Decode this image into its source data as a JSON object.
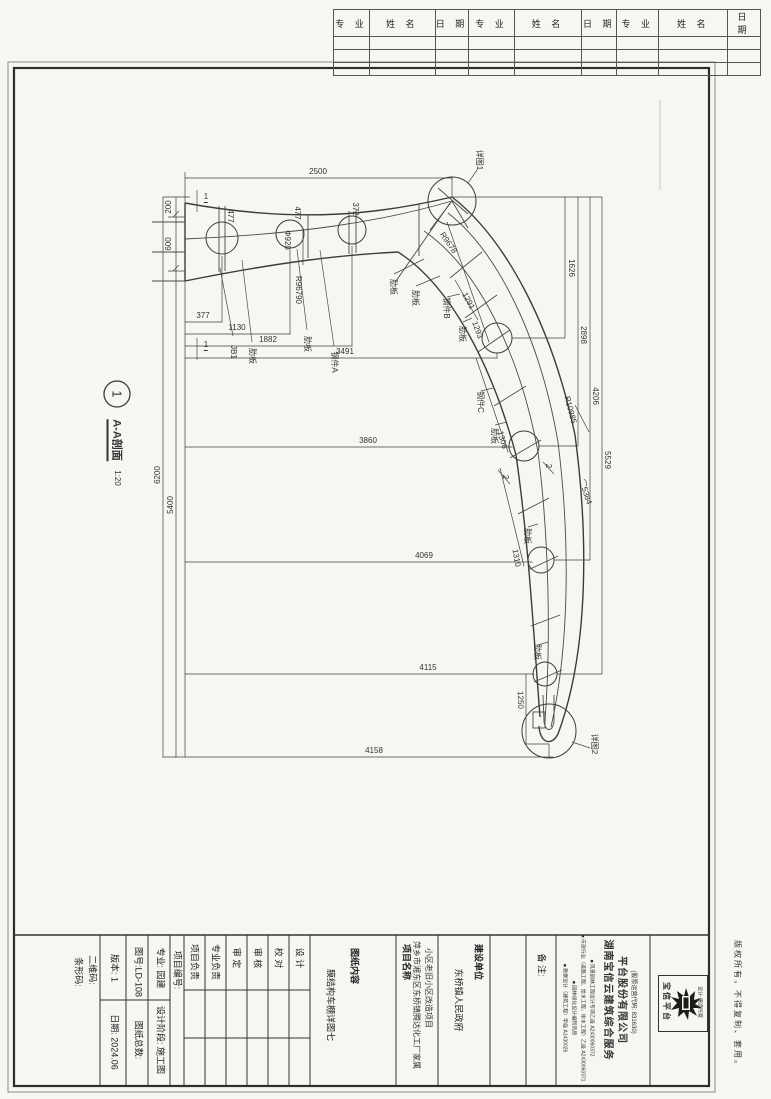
{
  "header_table": {
    "columns": [
      "专 业",
      "姓 名",
      "日 期",
      "专 业",
      "姓 名",
      "日 期",
      "专 业",
      "姓 名",
      "日 期"
    ],
    "empty_rows": 3
  },
  "drawing": {
    "section_callout": {
      "number": "1",
      "title": "A-A剖面",
      "scale": "1:20"
    },
    "labels": [
      {
        "t": "2500",
        "x": 318,
        "y": 172,
        "r": 0,
        "n": "dim-2500"
      },
      {
        "t": "200",
        "x": 169,
        "y": 207,
        "r": -90,
        "n": "dim-200"
      },
      {
        "t": "600",
        "x": 169,
        "y": 244,
        "r": -90,
        "n": "dim-600"
      },
      {
        "t": "6200",
        "x": 158,
        "y": 475,
        "r": -90,
        "n": "dim-6200"
      },
      {
        "t": "5400",
        "x": 171,
        "y": 505,
        "r": -90,
        "n": "dim-5400"
      },
      {
        "t": "477",
        "x": 230,
        "y": 216,
        "r": 90,
        "n": "dim-477"
      },
      {
        "t": "477",
        "x": 297,
        "y": 213,
        "r": 90,
        "n": "dim-477"
      },
      {
        "t": "372",
        "x": 355,
        "y": 209,
        "r": 90,
        "n": "dim-372"
      },
      {
        "t": "Φ920",
        "x": 287,
        "y": 240,
        "r": 90,
        "n": "dim-d920"
      },
      {
        "t": "R96790",
        "x": 298,
        "y": 290,
        "r": 90,
        "n": "dim-r96790"
      },
      {
        "t": "R9678",
        "x": 448,
        "y": 243,
        "r": 56,
        "n": "dim-r9678"
      },
      {
        "t": "1291",
        "x": 468,
        "y": 301,
        "r": 62,
        "n": "dim-1291"
      },
      {
        "t": "377",
        "x": 203,
        "y": 316,
        "r": 0,
        "n": "dim-377"
      },
      {
        "t": "1130",
        "x": 237,
        "y": 328,
        "r": 0,
        "n": "dim-1130"
      },
      {
        "t": "1882",
        "x": 268,
        "y": 340,
        "r": 0,
        "n": "dim-1882"
      },
      {
        "t": "3491",
        "x": 345,
        "y": 352,
        "r": 0,
        "n": "dim-3491"
      },
      {
        "t": "3860",
        "x": 368,
        "y": 441,
        "r": 0,
        "n": "dim-3860"
      },
      {
        "t": "4069",
        "x": 424,
        "y": 556,
        "r": 0,
        "n": "dim-4069"
      },
      {
        "t": "4115",
        "x": 428,
        "y": 668,
        "r": 0,
        "n": "dim-4115"
      },
      {
        "t": "4158",
        "x": 374,
        "y": 751,
        "r": 0,
        "n": "dim-4158"
      },
      {
        "t": "1626",
        "x": 571,
        "y": 268,
        "r": 90,
        "n": "dim-1626"
      },
      {
        "t": "2898",
        "x": 583,
        "y": 335,
        "r": 90,
        "n": "dim-2898"
      },
      {
        "t": "4206",
        "x": 595,
        "y": 396,
        "r": 90,
        "n": "dim-4206"
      },
      {
        "t": "5529",
        "x": 607,
        "y": 460,
        "r": 90,
        "n": "dim-5529"
      },
      {
        "t": "1293",
        "x": 477,
        "y": 330,
        "r": 70,
        "n": "dim-1293"
      },
      {
        "t": "1306",
        "x": 502,
        "y": 440,
        "r": 75,
        "n": "dim-1306"
      },
      {
        "t": "1310",
        "x": 516,
        "y": 558,
        "r": 80,
        "n": "dim-1310"
      },
      {
        "t": "1250",
        "x": 520,
        "y": 700,
        "r": 88,
        "n": "dim-1250"
      },
      {
        "t": "⌒5384",
        "x": 585,
        "y": 492,
        "r": 72,
        "n": "dim-5384"
      },
      {
        "t": "R10985",
        "x": 570,
        "y": 410,
        "r": 75,
        "n": "dim-r10985"
      },
      {
        "t": "JB1",
        "x": 233,
        "y": 352,
        "r": 90,
        "n": "part-callout"
      },
      {
        "t": "肋板",
        "x": 252,
        "y": 356,
        "r": 90,
        "n": "part-callout"
      },
      {
        "t": "肋板",
        "x": 307,
        "y": 344,
        "r": 90,
        "n": "part-callout"
      },
      {
        "t": "钢件A",
        "x": 334,
        "y": 362,
        "r": 90,
        "n": "part-callout"
      },
      {
        "t": "肋板",
        "x": 393,
        "y": 287,
        "r": 90,
        "n": "part-callout"
      },
      {
        "t": "肋板",
        "x": 415,
        "y": 298,
        "r": 90,
        "n": "part-callout"
      },
      {
        "t": "钢件B",
        "x": 446,
        "y": 308,
        "r": 90,
        "n": "part-callout"
      },
      {
        "t": "肋板",
        "x": 462,
        "y": 334,
        "r": 90,
        "n": "part-callout"
      },
      {
        "t": "钢件C",
        "x": 480,
        "y": 402,
        "r": 90,
        "n": "part-callout"
      },
      {
        "t": "肋板",
        "x": 494,
        "y": 436,
        "r": 90,
        "n": "part-callout"
      },
      {
        "t": "肋板",
        "x": 527,
        "y": 536,
        "r": 90,
        "n": "part-callout"
      },
      {
        "t": "肋板",
        "x": 537,
        "y": 652,
        "r": 90,
        "n": "part-callout"
      },
      {
        "t": "详图1",
        "x": 479,
        "y": 160,
        "r": 90,
        "n": "detail-1-callout"
      },
      {
        "t": "详图2",
        "x": 594,
        "y": 744,
        "r": 90,
        "n": "detail-2-callout"
      },
      {
        "t": "2",
        "x": 505,
        "y": 477,
        "r": 90,
        "n": "section-2-mark"
      },
      {
        "t": "2",
        "x": 548,
        "y": 466,
        "r": 90,
        "n": "section-2-mark"
      },
      {
        "t": "1",
        "x": 206,
        "y": 198,
        "r": 0,
        "u": true,
        "n": "section-1-mark"
      },
      {
        "t": "1",
        "x": 206,
        "y": 346,
        "r": 0,
        "u": true,
        "n": "section-1-mark"
      }
    ]
  },
  "title_block": {
    "barcode_label": "条形码:",
    "qrcode_label": "二维码:",
    "version_label": "版本: 1",
    "date_label": "日期: 2024.06",
    "drawing_no": "图号:LD-108",
    "sheet_total": "图纸总数:",
    "major": "专业: 园建",
    "stage": "设计阶段: 施工图",
    "project_no": "项目编号:",
    "roles": [
      "项目负责",
      "专业负责",
      "审  定",
      "审  核",
      "校  对",
      "设  计"
    ],
    "content_label": "图纸内容",
    "content_value": "膜结构车棚详图七",
    "project_label": "项目名称",
    "project_line1": "萍乡市湘东区东桥镇腾达化工厂家属",
    "project_line2": "小区老旧小区改造项目",
    "client_label": "建设单位",
    "client_value": "东桥镇人民政府",
    "notes_label": "备  注:",
    "company": {
      "name_line1": "湖南宝信云建筑综合服务",
      "name_line2": "平台股份有限公司",
      "stock_code": "(股票运营代码: 831630)",
      "certs": [
        "■ 勘察设计（建筑工程）甲级 A1430026",
        "■ 园林绿化设计编制资质",
        "■ 市政行业（道路工程、给水工程、排水工程）乙级 A2430060371",
        "■ 风景园林工程设计专项乙级 A2430060372"
      ]
    },
    "logo": {
      "name": "宝信平台",
      "tagline": "设计·建造托管"
    },
    "copyright": "版权所有，不得复制、套用。"
  }
}
